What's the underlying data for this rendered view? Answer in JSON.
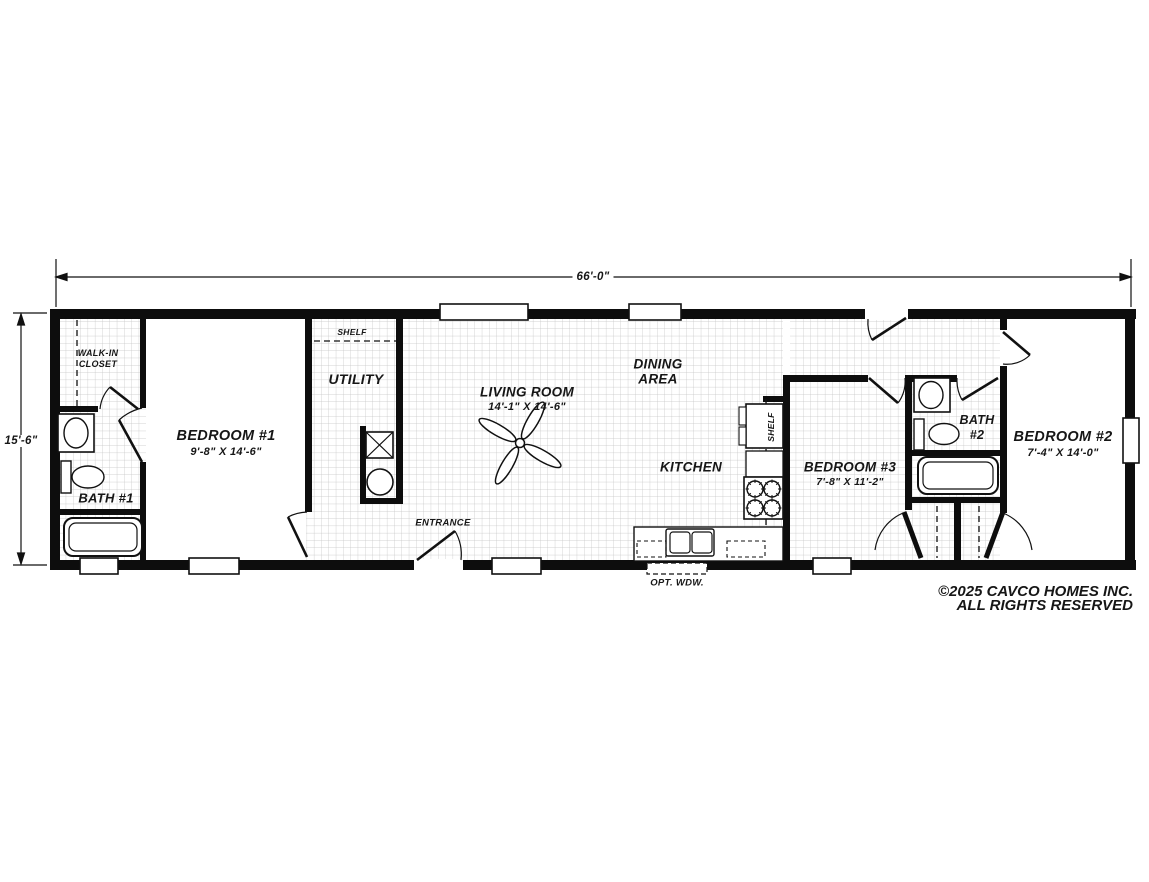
{
  "plan": {
    "title_dimensions": {
      "width": "66'-0\"",
      "depth": "15'-6\""
    },
    "rooms": {
      "walk_in_closet": {
        "line1": "WALK-IN",
        "line2": "CLOSET"
      },
      "bath1": {
        "name": "BATH #1"
      },
      "bedroom1": {
        "name": "BEDROOM #1",
        "size": "9'-8\" X 14'-6\""
      },
      "utility": {
        "name": "UTILITY",
        "shelf": "SHELF"
      },
      "living": {
        "name": "LIVING ROOM",
        "size": "14'-1\" X 14'-6\""
      },
      "dining": {
        "line1": "DINING",
        "line2": "AREA"
      },
      "kitchen": {
        "name": "KITCHEN",
        "shelf": "SHELF",
        "opt_window": "OPT. WDW."
      },
      "entrance": {
        "name": "ENTRANCE"
      },
      "bedroom3": {
        "name": "BEDROOM #3",
        "size": "7'-8\" X 11'-2\""
      },
      "bath2": {
        "line1": "BATH",
        "line2": "#2"
      },
      "bedroom2": {
        "name": "BEDROOM #2",
        "size": "7'-4\" X 14'-0\""
      }
    },
    "copyright": {
      "line1": "©2025 CAVCO HOMES INC.",
      "line2": "ALL RIGHTS RESERVED"
    },
    "colors": {
      "wall": "#0d0d0d",
      "grid": "#c3c3c3",
      "background": "#ffffff"
    }
  }
}
